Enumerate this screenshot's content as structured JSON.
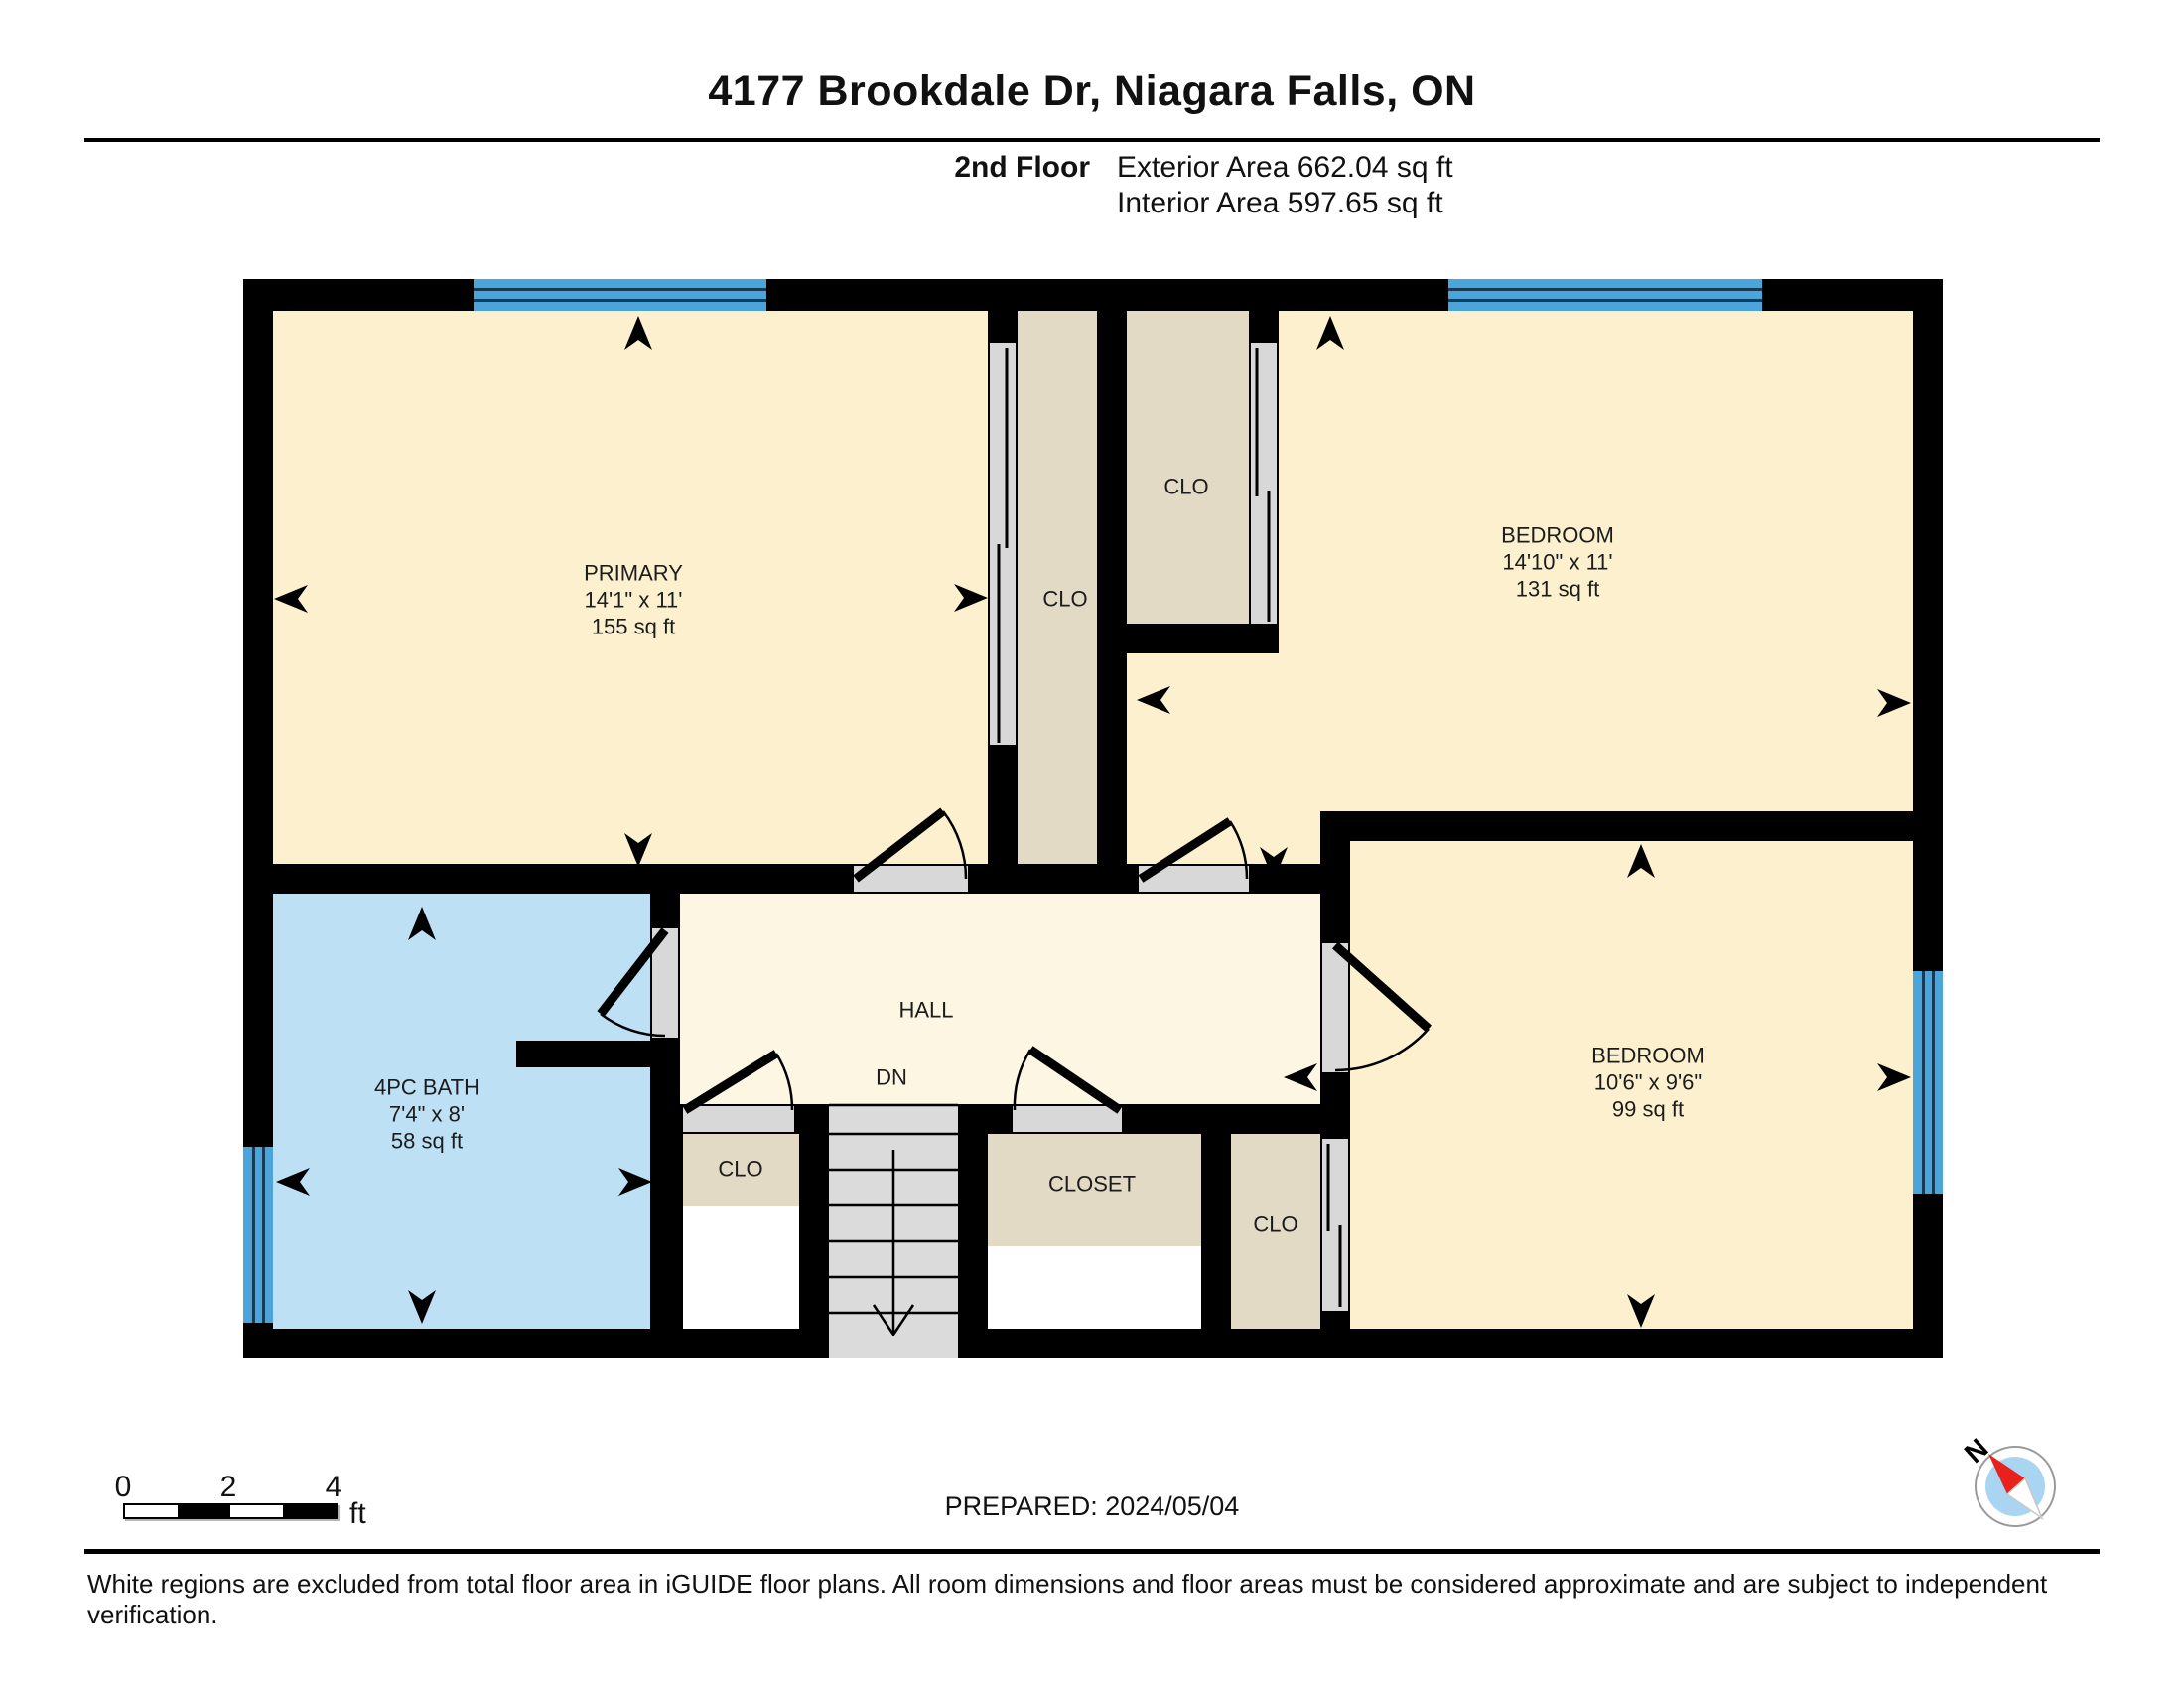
{
  "header": {
    "title": "4177 Brookdale Dr, Niagara Falls, ON",
    "floor_label": "2nd Floor",
    "exterior_area": "Exterior Area 662.04 sq ft",
    "interior_area": "Interior Area 597.65 sq ft"
  },
  "rooms": {
    "primary": {
      "name": "PRIMARY",
      "dims": "14'1\" x 11'",
      "area": "155 sq ft"
    },
    "bedroom_top": {
      "name": "BEDROOM",
      "dims": "14'10\" x 11'",
      "area": "131 sq ft"
    },
    "bedroom_bottom": {
      "name": "BEDROOM",
      "dims": "10'6\" x 9'6\"",
      "area": "99 sq ft"
    },
    "bath": {
      "name": "4PC BATH",
      "dims": "7'4\" x 8'",
      "area": "58 sq ft"
    },
    "hall": {
      "name": "HALL"
    },
    "stairs_label": "DN",
    "closet_center": "CLO",
    "closet_top": "CLO",
    "closet_hall_small": "CLO",
    "closet_hall_large": "CLOSET",
    "closet_bottom": "CLO"
  },
  "scale_bar": {
    "labels": [
      "0",
      "2",
      "4"
    ],
    "unit": "ft"
  },
  "compass": {
    "north_label": "N"
  },
  "footer": {
    "prepared": "PREPARED: 2024/05/04",
    "disclaimer": "White regions are excluded from total floor area in iGUIDE floor plans. All room dimensions and floor areas must be considered approximate and are subject to independent verification."
  },
  "colors": {
    "room": "#FCF0CE",
    "hall": "#FDF6E3",
    "closet": "#E3DAC6",
    "bath": "#BEE0F5",
    "window": "#4BA5DB",
    "void": "#FFFFFF",
    "threshold": "#D8D8D8",
    "stairs": "#DBDBDB",
    "wall": "#000000",
    "compass-needle": "#E8211D",
    "compass-face": "#A9D5F2"
  }
}
